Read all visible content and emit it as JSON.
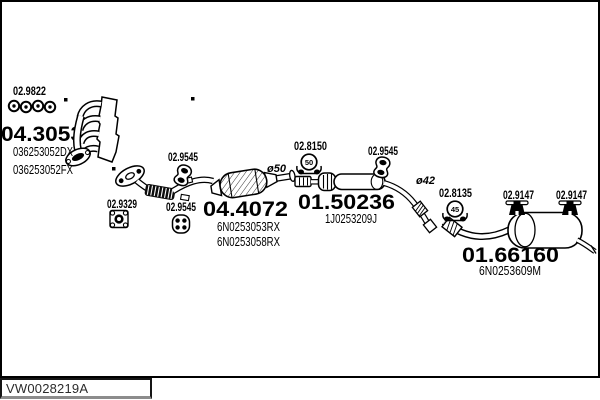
{
  "frame": {
    "border_color": "#000000",
    "background": "#ffffff"
  },
  "footer": {
    "drawing_code": "VW0028219A"
  },
  "parts": {
    "manifold": {
      "code": "04.3053",
      "oe": [
        "036253052DX",
        "036253052FX"
      ],
      "gasket_code": "02.9822"
    },
    "front_pipe": {
      "code": "04.4072",
      "oe": [
        "6N0253053RX",
        "6N0253058RX"
      ],
      "flange_gasket_code": "02.9329",
      "hanger_front_code": "02.9545",
      "hanger_rear_code": "02.9545"
    },
    "mid_muffler": {
      "code": "01.50236",
      "oe": "1J0253209J",
      "inlet_diameter": "ø50",
      "clamp_code": "02.8150",
      "clamp_size": "50",
      "hanger_code": "02.9545"
    },
    "rear_muffler": {
      "code": "01.66160",
      "oe": "6N0253609M",
      "inlet_diameter": "ø42",
      "clamp_code": "02.8135",
      "clamp_size": "45",
      "hanger_front_code": "02.9147",
      "hanger_rear_code": "02.9147"
    }
  }
}
